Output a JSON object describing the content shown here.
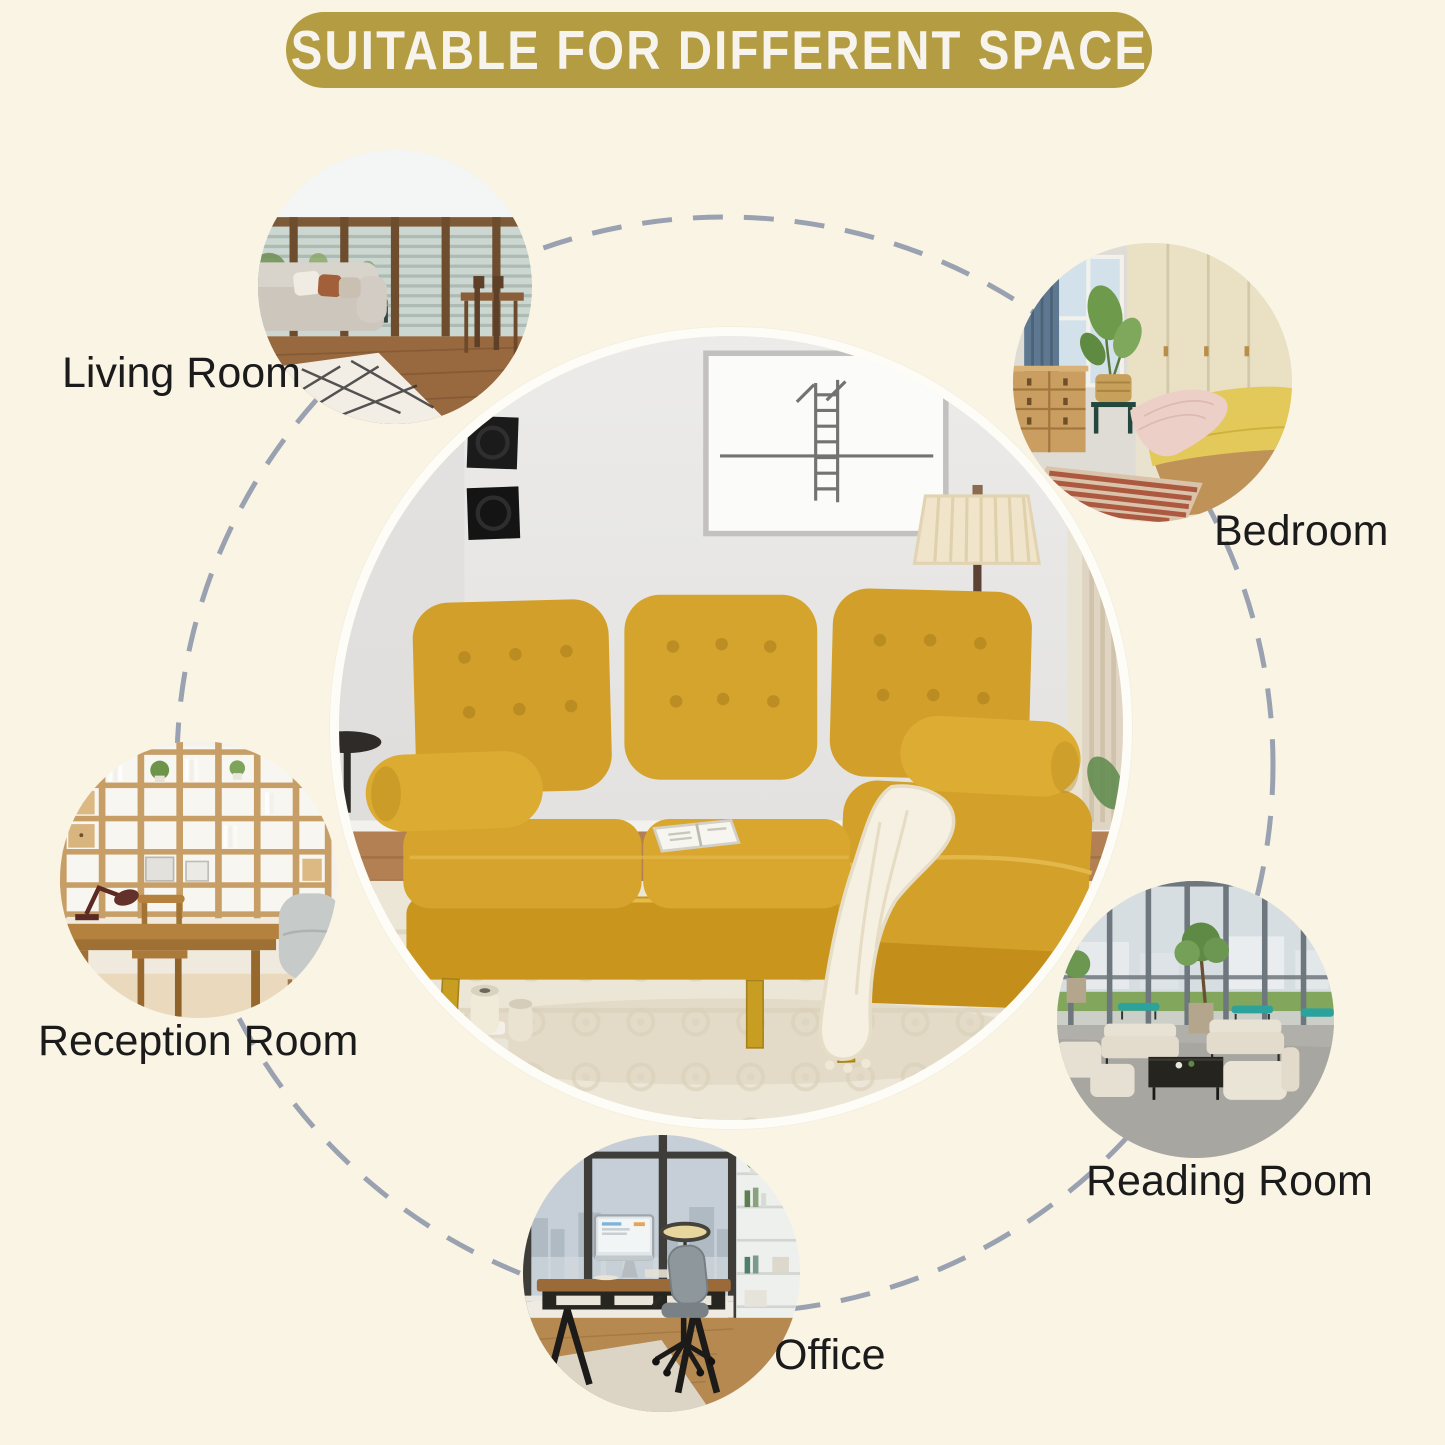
{
  "title": {
    "text": "SUITABLE FOR DIFFERENT SPACE"
  },
  "spaces": [
    {
      "id": "living-room",
      "label": "Living Room"
    },
    {
      "id": "bedroom",
      "label": "Bedroom"
    },
    {
      "id": "reception-room",
      "label": "Reception Room"
    },
    {
      "id": "reading-room",
      "label": "Reading Room"
    },
    {
      "id": "office",
      "label": "Office"
    }
  ],
  "colors": {
    "background": "#f9f4e4",
    "banner": "#b49c42",
    "banner_text": "#f6f4ec",
    "label_text": "#1b1b1b",
    "dash": "#9aa1b0",
    "sofa_yellow": "#d2a02a",
    "leg_gold": "#c79e22"
  }
}
